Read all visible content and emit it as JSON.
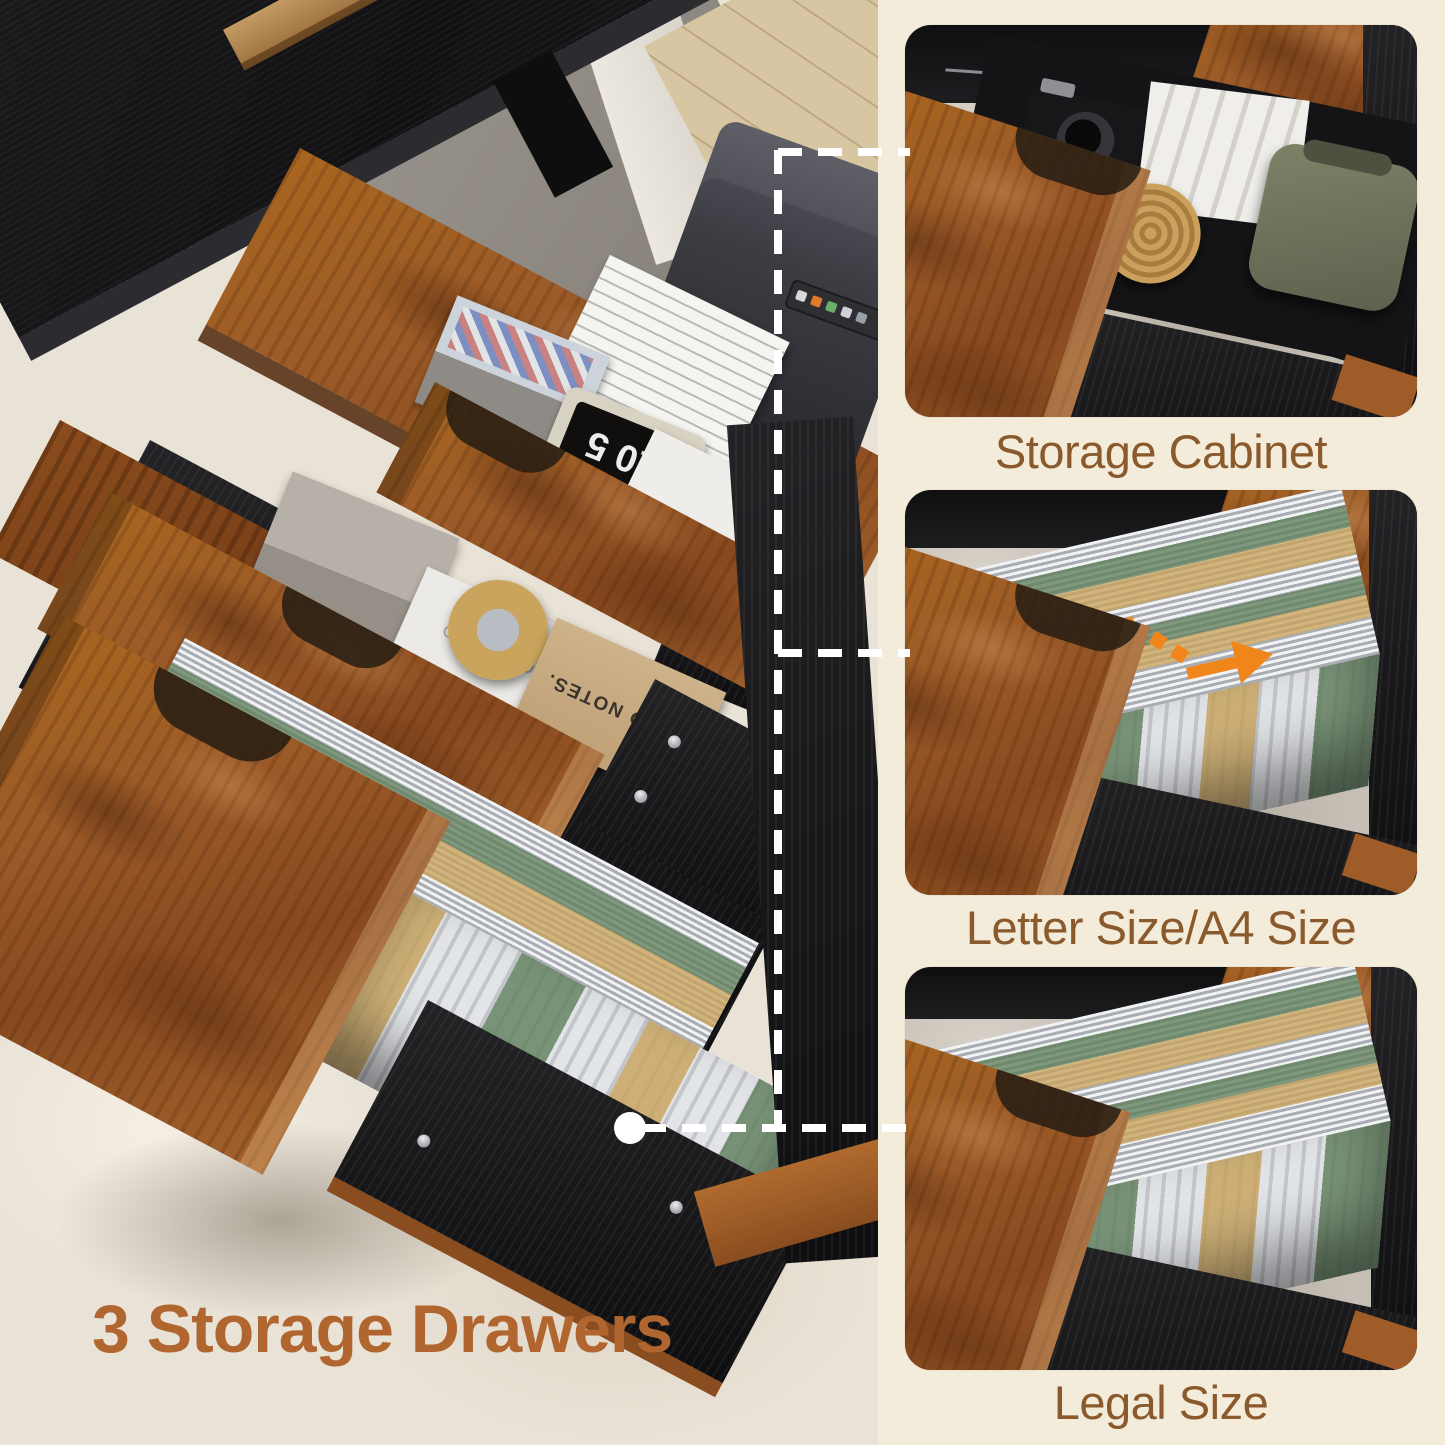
{
  "headline": {
    "label": "3 Storage Drawers"
  },
  "panels": [
    {
      "id": "storage-cabinet",
      "caption": "Storage Cabinet"
    },
    {
      "id": "letter-a4",
      "caption": "Letter Size/A4 Size"
    },
    {
      "id": "legal",
      "caption": "Legal Size"
    }
  ],
  "photo_text": {
    "clock_display": "10 5",
    "notepad_brand": "NOTEPAD",
    "notebook_brand": "FIELD NOTES.",
    "paper_spine": "MAT"
  },
  "annotations": {
    "connector_line": "white-dashed-line",
    "connector_dot": "white-circle",
    "resize_arrows": "orange-double-arrow"
  },
  "colors": {
    "background": "#f4ecdb",
    "headline": "#b1662f",
    "caption": "#8a592c",
    "wood": "#9b5a28",
    "wood_dark": "#6b3a16",
    "wood_light": "#c08146",
    "black_wood": "#1b1b1d",
    "rug_main": "#e9e2d6",
    "rug_panel": "#c6bfb5",
    "file_white": "#e8eaec",
    "file_green": "#5f7f5c",
    "file_tan": "#c9a35b",
    "arrow_orange": "#f08519",
    "connector": "#ffffff"
  }
}
